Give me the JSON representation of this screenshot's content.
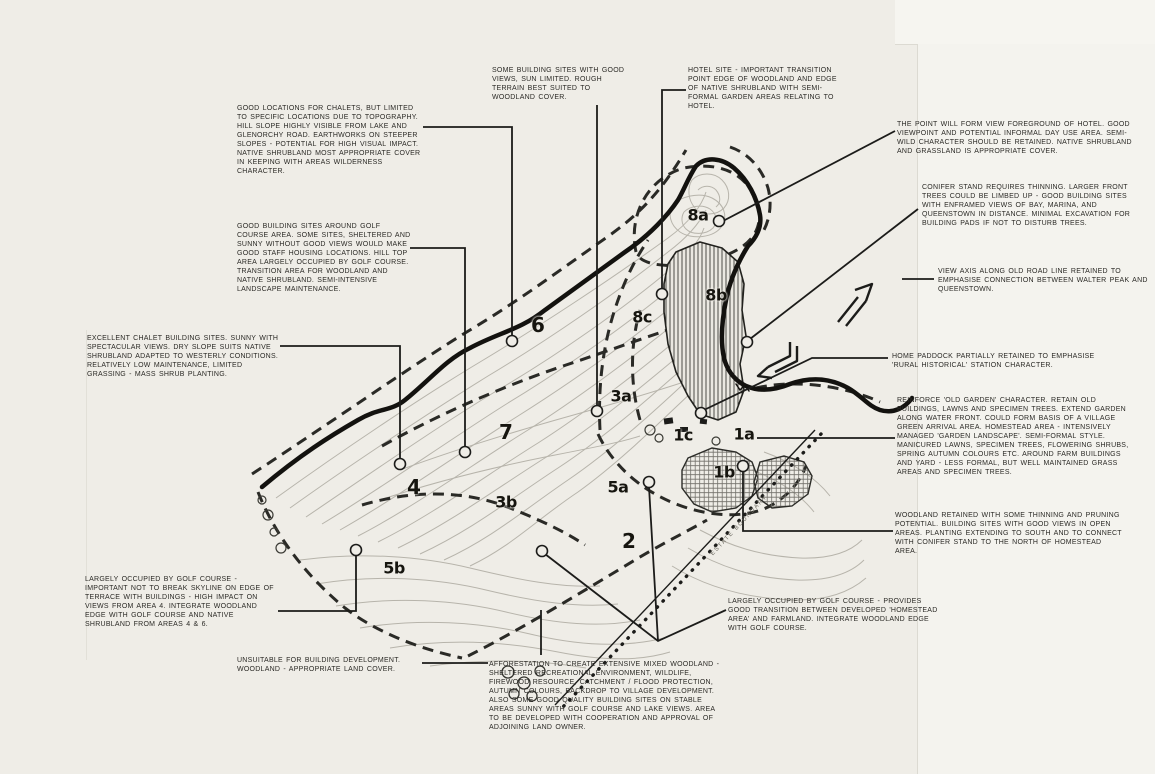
{
  "document": {
    "type": "hand-drawn landscape site analysis plan",
    "paper_color": "#efede7",
    "ink_color": "#1c1c1a",
    "contour_color": "#b7b4ab"
  },
  "boundary_label": "ESTATE BOUNDARY",
  "zones": {
    "z6": "6",
    "z7": "7",
    "z4": "4",
    "z2": "2",
    "z3a": "3a",
    "z3b": "3b",
    "z5a": "5a",
    "z5b": "5b",
    "z8a": "8a",
    "z8b": "8b",
    "z8c": "8c",
    "z1a": "1a",
    "z1b": "1b",
    "z1c": "1c"
  },
  "annotations": {
    "a1": {
      "text": "GOOD LOCATIONS FOR CHALETS, BUT LIMITED TO SPECIFIC LOCATIONS DUE TO TOPOGRAPHY. HILL SLOPE HIGHLY VISIBLE FROM LAKE AND GLENORCHY ROAD. EARTHWORKS ON STEEPER SLOPES - POTENTIAL FOR HIGH VISUAL IMPACT. NATIVE SHRUBLAND MOST APPROPRIATE COVER IN KEEPING WITH AREAS WILDERNESS CHARACTER."
    },
    "a2": {
      "text": "SOME BUILDING SITES WITH GOOD VIEWS, SUN LIMITED. ROUGH TERRAIN BEST SUITED TO WOODLAND COVER."
    },
    "a3": {
      "text": "HOTEL SITE - IMPORTANT TRANSITION POINT EDGE OF WOODLAND AND EDGE OF NATIVE SHRUBLAND WITH SEMI-FORMAL GARDEN AREAS RELATING TO HOTEL."
    },
    "a4": {
      "text": "THE POINT WILL FORM VIEW FOREGROUND OF HOTEL. GOOD VIEWPOINT AND POTENTIAL INFORMAL DAY USE AREA. SEMI-WILD CHARACTER SHOULD BE RETAINED. NATIVE SHRUBLAND AND GRASSLAND IS APPROPRIATE COVER."
    },
    "a5": {
      "text": "CONIFER STAND REQUIRES THINNING. LARGER FRONT TREES COULD BE LIMBED UP - GOOD BUILDING SITES WITH ENFRAMED VIEWS OF BAY, MARINA, AND QUEENSTOWN IN DISTANCE. MINIMAL EXCAVATION FOR BUILDING PADS IF NOT TO DISTURB TREES."
    },
    "a6": {
      "text": "VIEW AXIS ALONG OLD ROAD LINE RETAINED TO EMPHASISE CONNECTION BETWEEN WALTER PEAK AND QUEENSTOWN."
    },
    "a7": {
      "text": "HOME PADDOCK PARTIALLY RETAINED TO EMPHASISE 'RURAL HISTORICAL' STATION CHARACTER."
    },
    "a8": {
      "text": "REINFORCE 'OLD GARDEN' CHARACTER. RETAIN OLD BUILDINGS, LAWNS AND SPECIMEN TREES. EXTEND GARDEN ALONG WATER FRONT. COULD FORM BASIS OF A VILLAGE GREEN ARRIVAL AREA. HOMESTEAD AREA - INTENSIVELY MANAGED 'GARDEN LANDSCAPE'. SEMI-FORMAL STYLE. MANICURED LAWNS, SPECIMEN TREES, FLOWERING SHRUBS, SPRING AUTUMN COLOURS ETC. AROUND FARM BUILDINGS AND YARD - LESS FORMAL, BUT WELL MAINTAINED GRASS AREAS AND SPECIMEN TREES."
    },
    "a9": {
      "text": "WOODLAND RETAINED WITH SOME THINNING AND PRUNING POTENTIAL. BUILDING SITES WITH GOOD VIEWS IN OPEN AREAS. PLANTING EXTENDING TO SOUTH AND TO CONNECT WITH CONIFER STAND TO THE NORTH OF HOMESTEAD AREA."
    },
    "a10": {
      "text": "GOOD BUILDING SITES AROUND GOLF COURSE AREA. SOME SITES, SHELTERED AND SUNNY WITHOUT GOOD VIEWS WOULD MAKE GOOD STAFF HOUSING LOCATIONS. HILL TOP AREA LARGELY OCCUPIED BY GOLF COURSE. TRANSITION AREA FOR WOODLAND AND NATIVE SHRUBLAND. SEMI-INTENSIVE LANDSCAPE MAINTENANCE."
    },
    "a11": {
      "text": "EXCELLENT CHALET BUILDING SITES. SUNNY WITH SPECTACULAR VIEWS. DRY SLOPE SUITS NATIVE SHRUBLAND ADAPTED TO WESTERLY CONDITIONS. RELATIVELY LOW MAINTENANCE, LIMITED GRASSING - MASS SHRUB PLANTING."
    },
    "a12": {
      "text": "LARGELY OCCUPIED BY GOLF COURSE - IMPORTANT NOT TO BREAK SKYLINE ON EDGE OF TERRACE WITH BUILDINGS - HIGH IMPACT ON VIEWS FROM AREA 4. INTEGRATE WOODLAND EDGE WITH GOLF COURSE AND NATIVE SHRUBLAND FROM AREAS 4 & 6."
    },
    "a13": {
      "text": "UNSUITABLE FOR BUILDING DEVELOPMENT. WOODLAND - APPROPRIATE LAND COVER."
    },
    "a14": {
      "text": "AFFORESTATION TO CREATE EXTENSIVE MIXED WOODLAND - SHELTERED RECREATIONAL ENVIRONMENT, WILDLIFE, FIREWOOD RESOURCE, CATCHMENT / FLOOD PROTECTION, AUTUMN COLOURS, BACKDROP TO VILLAGE DEVELOPMENT. ALSO SOME GOOD QUALITY BUILDING SITES ON STABLE AREAS SUNNY WITH GOLF COURSE AND LAKE VIEWS. AREA TO BE DEVELOPED WITH COOPERATION AND APPROVAL OF ADJOINING LAND OWNER."
    },
    "a15": {
      "text": "LARGELY OCCUPIED BY GOLF COURSE - PROVIDES GOOD TRANSITION BETWEEN DEVELOPED 'HOMESTEAD AREA' AND FARMLAND. INTEGRATE WOODLAND EDGE WITH GOLF COURSE."
    }
  }
}
